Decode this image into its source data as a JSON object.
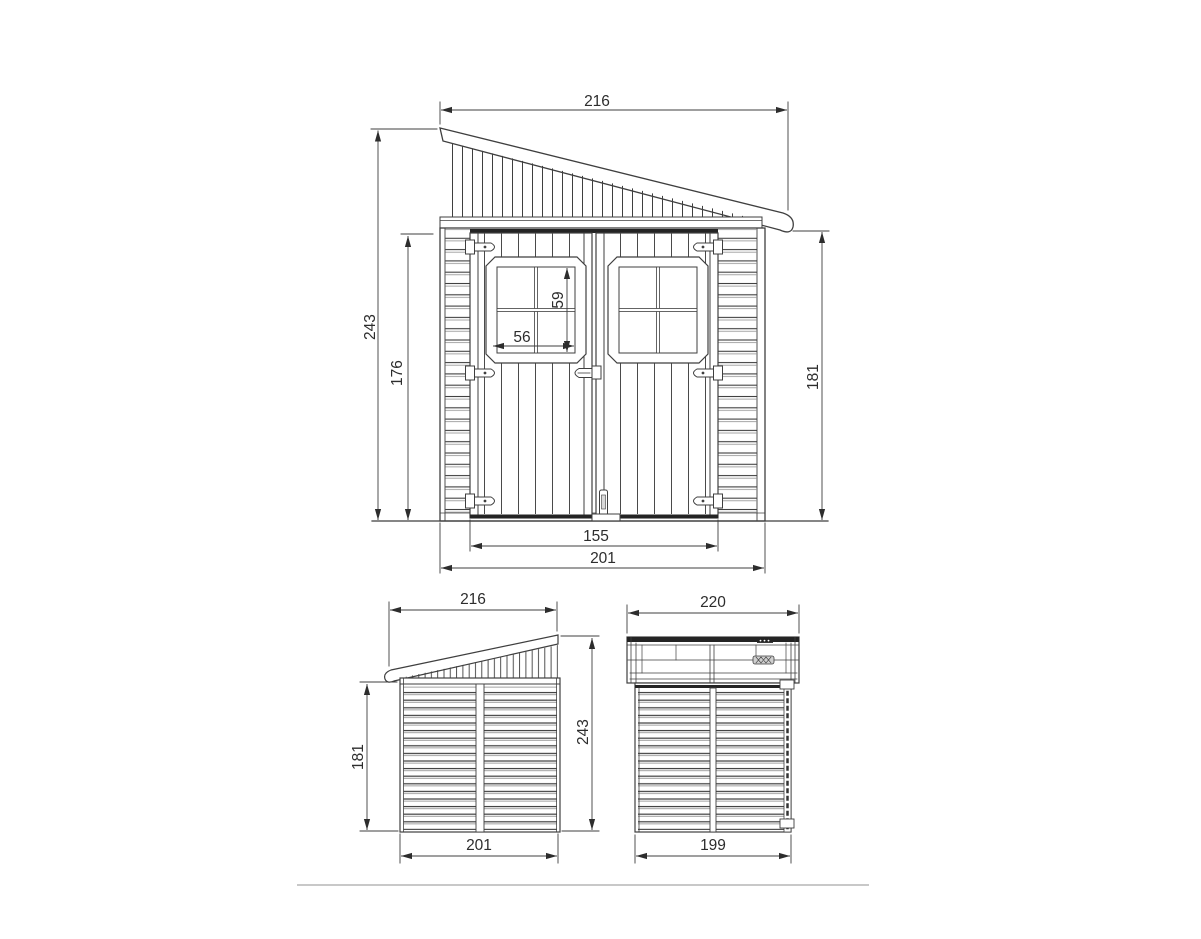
{
  "drawing": {
    "colors": {
      "line": "#3f3f3f",
      "dark_band": "#242424",
      "dim_text": "#2d2d2d",
      "divider": "#c8c8c8",
      "background": "#ffffff"
    }
  },
  "front_view": {
    "dims": {
      "roof_width": "216",
      "overall_height": "243",
      "door_height": "176",
      "wall_height": "181",
      "window_height": "59",
      "window_width": "56",
      "door_opening_width": "155",
      "body_width": "201"
    }
  },
  "side_view": {
    "dims": {
      "roof_depth": "216",
      "wall_height": "181",
      "overall_height": "243",
      "body_depth": "201"
    }
  },
  "rear_view": {
    "dims": {
      "roof_width": "220",
      "body_width": "199"
    }
  }
}
